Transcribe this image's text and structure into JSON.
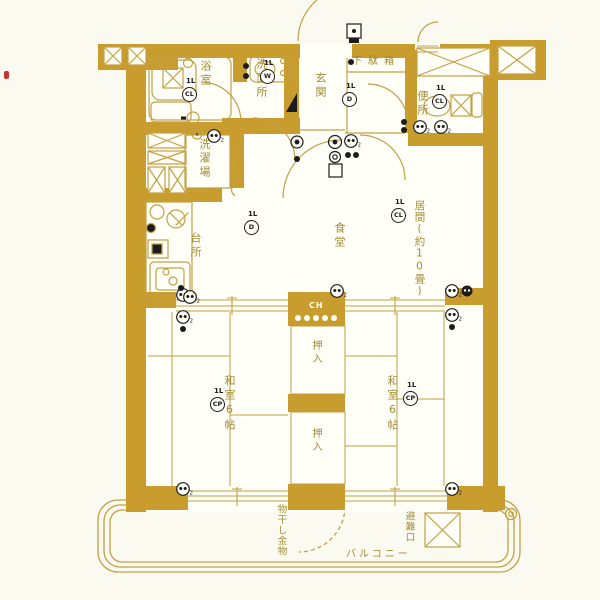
{
  "plan": {
    "rooms": {
      "bathroom": "浴室",
      "washroom": "洗面所",
      "laundry": "洗濯場",
      "entrance": "玄関",
      "shoe_cabinet": "下駄箱",
      "toilet": "便所",
      "kitchen": "台所",
      "dining": "食堂",
      "living": "居間(約10畳)",
      "japanese_room_left": "和室6帖",
      "japanese_room_right": "和室6帖",
      "closet_upper": "押入",
      "closet_lower": "押入",
      "balcony": "バルコニー",
      "laundry_hanger": "物干し金物",
      "emergency_exit": "避難口"
    },
    "marks": {
      "ch": "CH",
      "light": "1L",
      "type_cl": "CL",
      "type_d": "D",
      "type_cp": "CP",
      "type_w": "W",
      "outlet_sub": "2"
    },
    "colors": {
      "wall": "#c89d2e",
      "line": "#c2a045",
      "label": "#a18c36",
      "symbol": "#1c1c1c",
      "background": "#fbfaf1",
      "red_mark": "#c8342a"
    }
  }
}
